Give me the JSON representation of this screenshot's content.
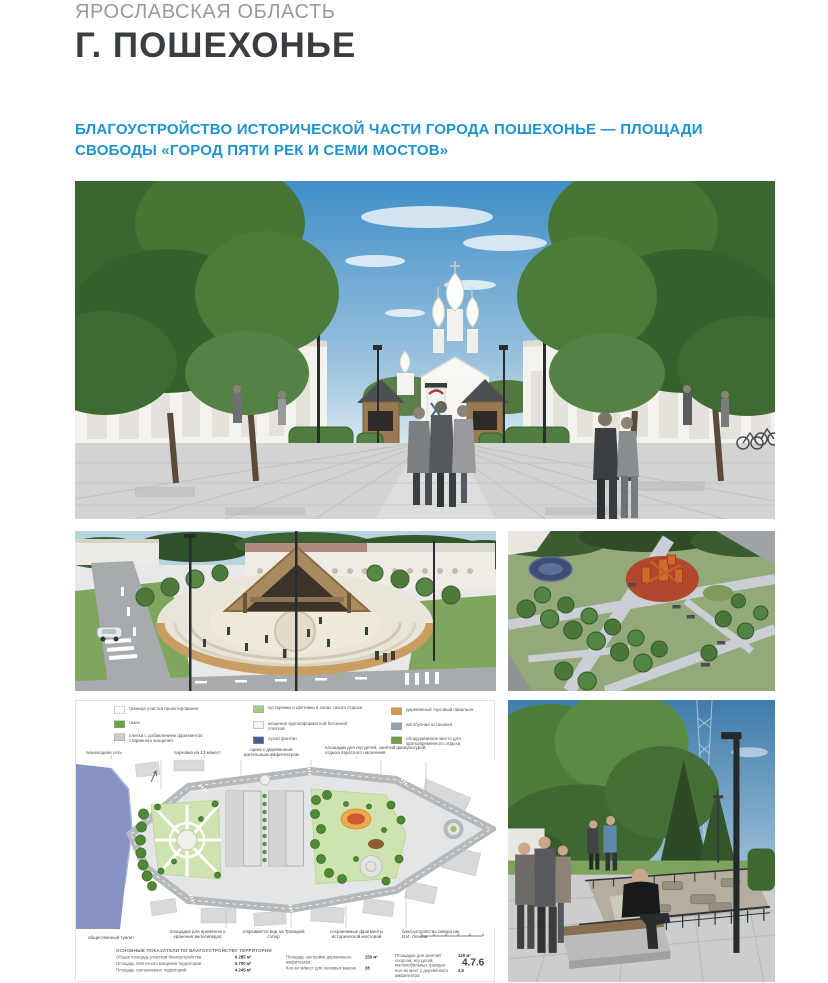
{
  "page": {
    "region_label": "ЯРОСЛАВСКАЯ ОБЛАСТЬ",
    "city_title": "Г. ПОШЕХОНЬЕ",
    "subtitle_line1": "БЛАГОУСТРОЙСТВО ИСТОРИЧЕСКОЙ ЧАСТИ ГОРОДА ПОШЕХОНЬЕ — ПЛОЩАДИ",
    "subtitle_line2": "СВОБОДЫ «ГОРОД ПЯТИ РЕК И СЕМИ МОСТОВ»",
    "page_number": "4.7.6"
  },
  "colors": {
    "accent_blue": "#1e93cf",
    "title_dark": "#3b3e41",
    "muted_gray": "#97999c",
    "plan_river": "#8793c3",
    "plan_green": "#cfe3af",
    "plan_playground_orange": "#eda94e"
  },
  "figures": {
    "main_render": "square-with-church-render",
    "amphitheater_render": "amphitheater-aerial-render",
    "playground_render": "playground-aerial-render",
    "park_render": "park-path-render",
    "masterplan": "masterplan-drawing"
  },
  "masterplan": {
    "legend": {
      "col1": [
        {
          "swatch": "#ffffff",
          "label": "граница участка проектирования"
        },
        {
          "swatch": "#6aa341",
          "label": "газон"
        },
        {
          "swatch": "#c9cccd",
          "label": "плитка с добавлением фрагментов старинного мощения"
        }
      ],
      "col2": [
        {
          "swatch": "#a8c98a",
          "label": "кустарники и цветники в зонах тихого отдыха"
        },
        {
          "swatch": "#f4f4f2",
          "label": "мощение крупноформатной бетонной плиткой"
        },
        {
          "swatch": "#4a5a8f",
          "label": "сухой фонтан"
        }
      ],
      "col3": [
        {
          "swatch": "#d79a4c",
          "label": "деревянный торговый павильон"
        },
        {
          "swatch": "#8fa3b5",
          "label": "автобусная остановка"
        },
        {
          "swatch": "#6f9d4f",
          "label": "оборудованное место для кратковременного отдыха"
        }
      ]
    },
    "callouts_top": [
      {
        "text": "пешеходная сеть"
      },
      {
        "text": "парковка на 13 м/мест"
      },
      {
        "text": "сцена с деревянным зрительным амфитеатром"
      },
      {
        "text": "площадки для игр детей, занятий физкультурой, отдыха взрослого населения"
      },
      {
        "text": "деревянные качели"
      },
      {
        "text": "композиция «ПЯТЬ РЕК ПОШЕХОНЬЯ»"
      }
    ],
    "callout_right": "двухуровневый амфитеатр",
    "callout_bottom_center": "разворотная площадка пожарных автомобилей",
    "callouts_bottom": [
      {
        "text": "общественный туалет"
      },
      {
        "text": "площадка для временного хранения велосипедов"
      },
      {
        "text": "открывается вид на Троицкий собор"
      },
      {
        "text": "сохраняемые фрагменты исторической мостовой"
      },
      {
        "text": "благоустройство сквера им. В.И. Ленина"
      }
    ],
    "indicators": {
      "heading": "ОСНОВНЫЕ ПОКАЗАТЕЛИ ПО БЛАГОУСТРОЙСТВУ ТЕРРИТОРИИ",
      "col1": [
        {
          "label": "Общая площадь участков благоустройства",
          "value": "6 285 м²"
        },
        {
          "label": "Площадь плиточного мощения территории",
          "value": "5 700 м²"
        },
        {
          "label": "Площадь озеленяемых территорий",
          "value": "4 245 м²"
        }
      ],
      "col2": [
        {
          "label": "Площадь застройки деревянного амфитеатра",
          "value": "250 м²"
        },
        {
          "label": "Кол-во м/мест для легковых машин",
          "value": "28"
        }
      ],
      "col3": [
        {
          "label": "Площадки для занятий спортом, игр детей, маломобильных граждан",
          "value": "120 м²"
        },
        {
          "label": "Кол-во мест у деревянного амфитеатра",
          "value": "4,6"
        }
      ]
    }
  }
}
